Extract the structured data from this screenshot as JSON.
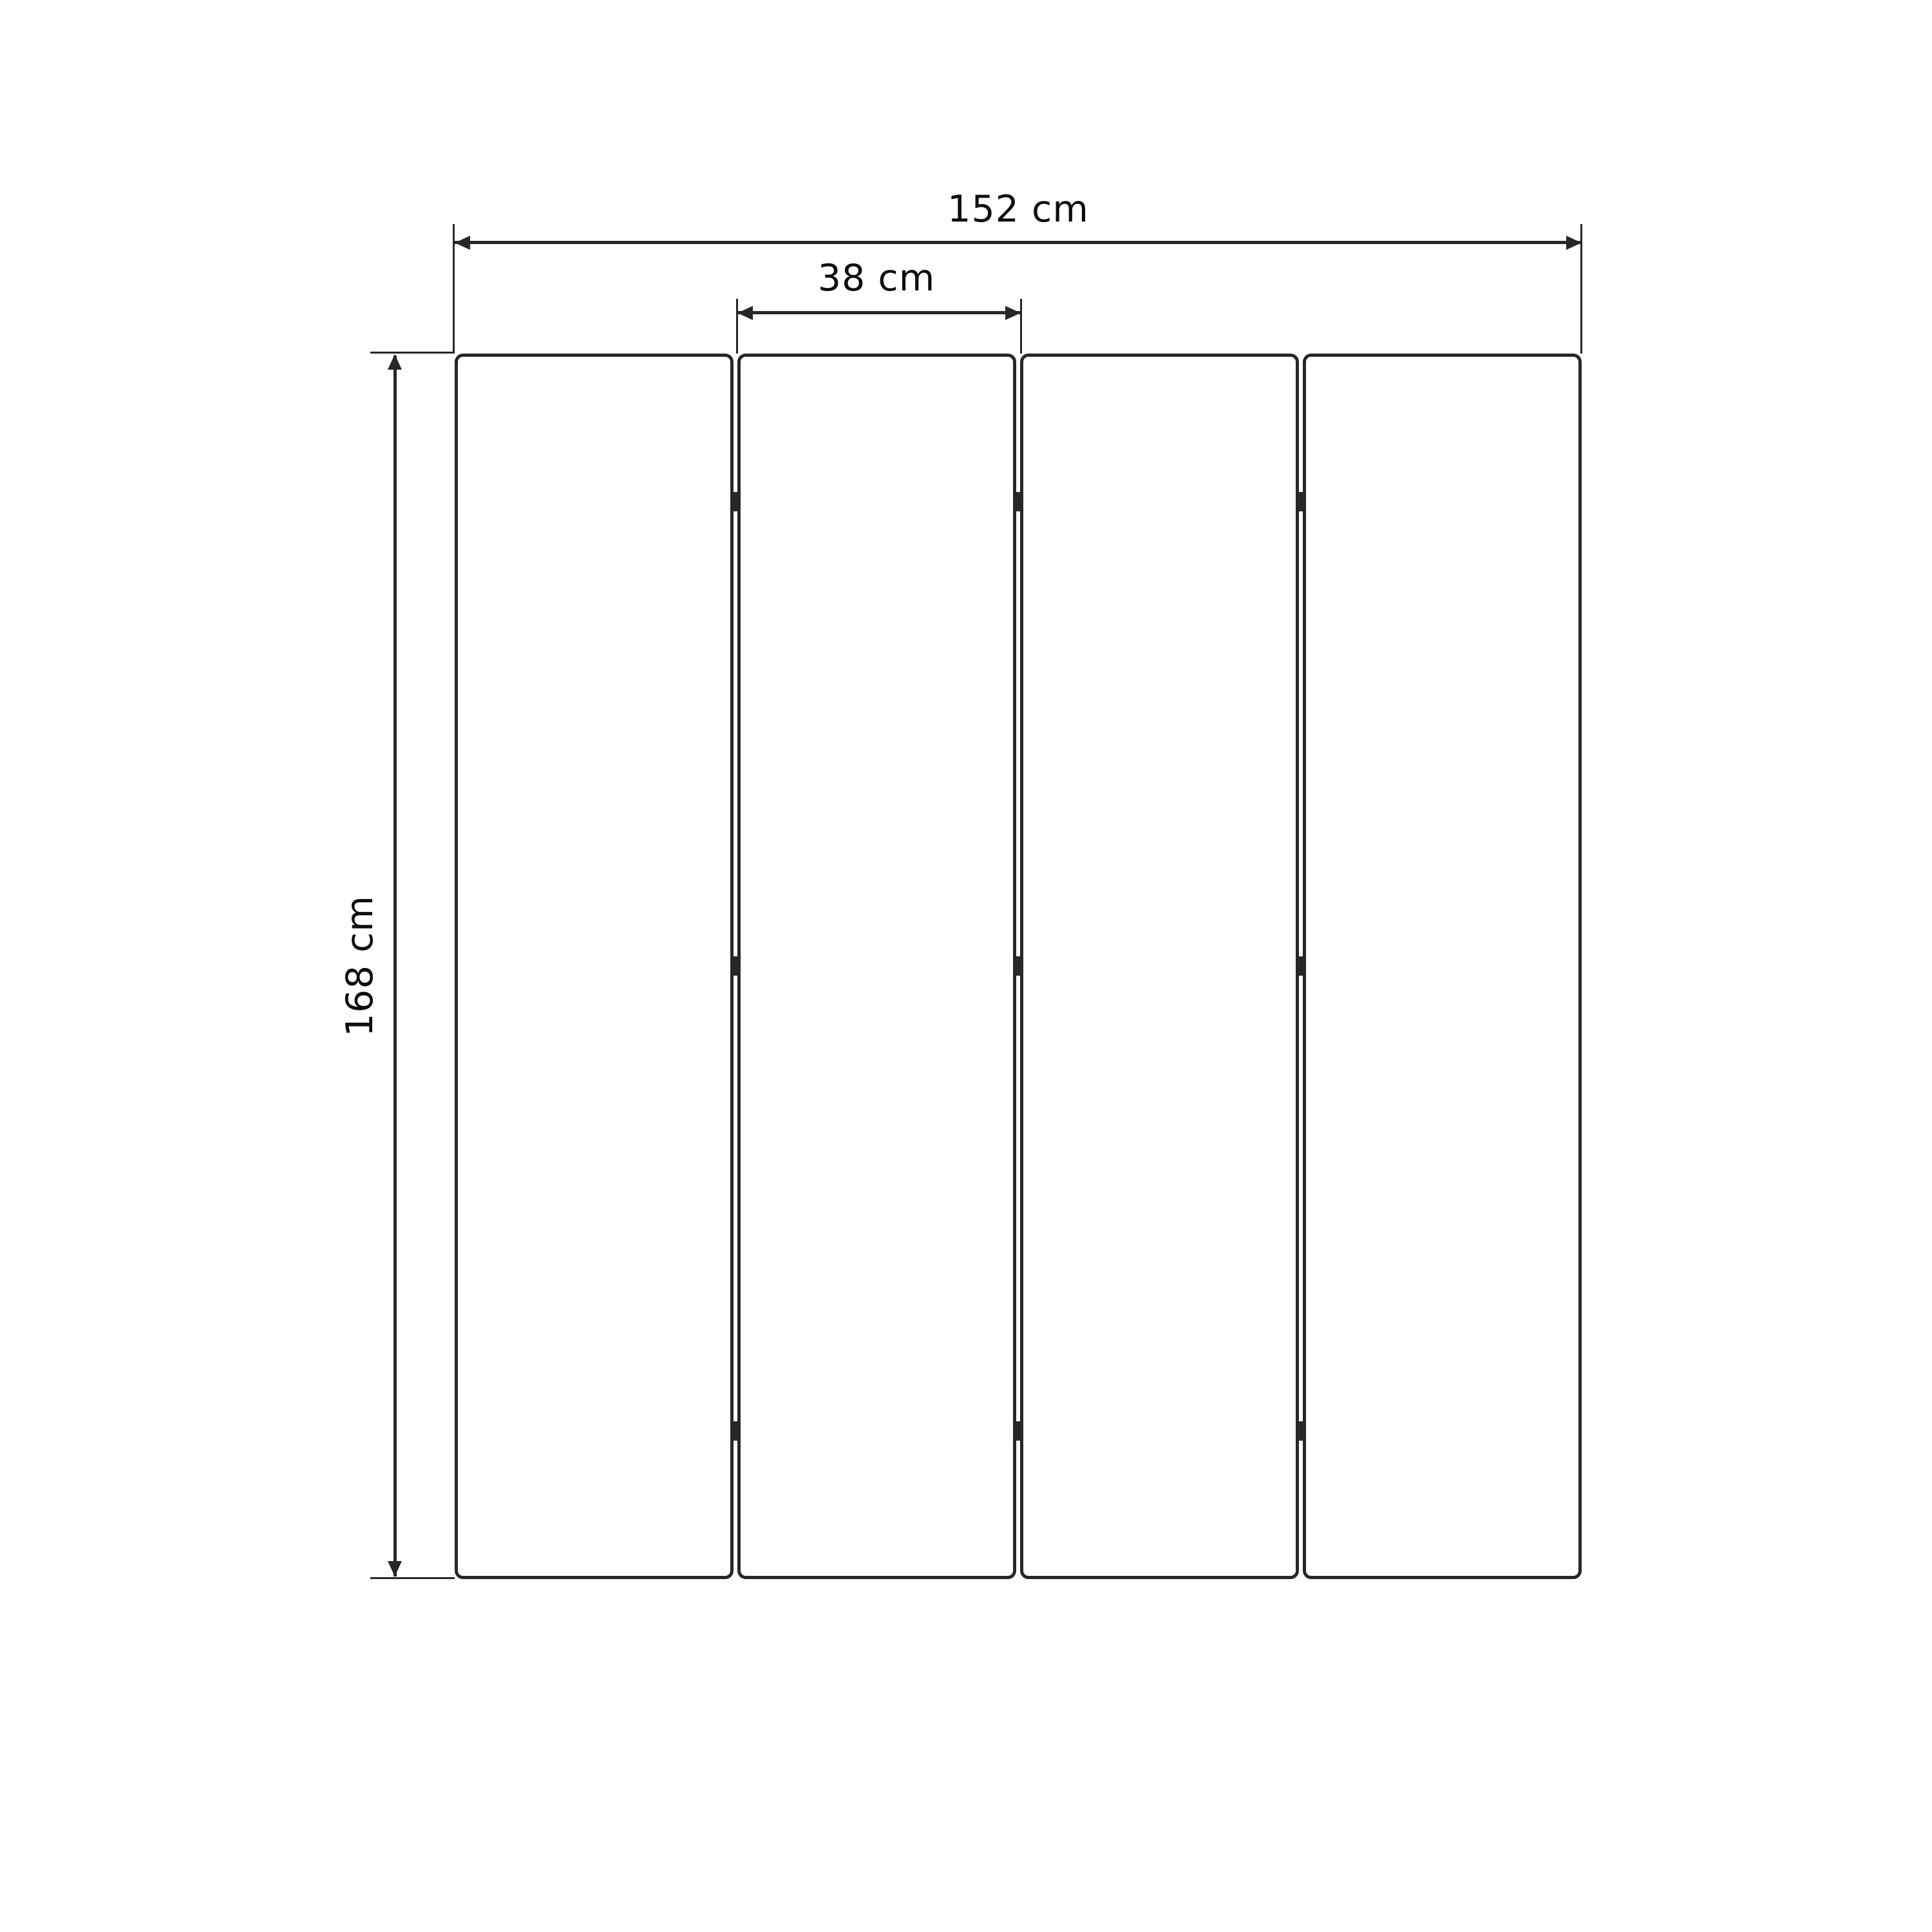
{
  "diagram": {
    "title": "Folding screen dimension drawing",
    "object": "4-panel folding screen, front elevation",
    "panel_count": 4,
    "gap_count": 3,
    "hinges_per_gap": 3,
    "dimensions": {
      "total_width": {
        "label": "152 cm",
        "value": 152,
        "unit": "cm"
      },
      "panel_width": {
        "label": "38 cm",
        "value": 38,
        "unit": "cm"
      },
      "height": {
        "label": "168 cm",
        "value": 168,
        "unit": "cm"
      }
    },
    "colors": {
      "line": "#272727",
      "text": "#0d0d0d",
      "background": "#ffffff"
    }
  }
}
